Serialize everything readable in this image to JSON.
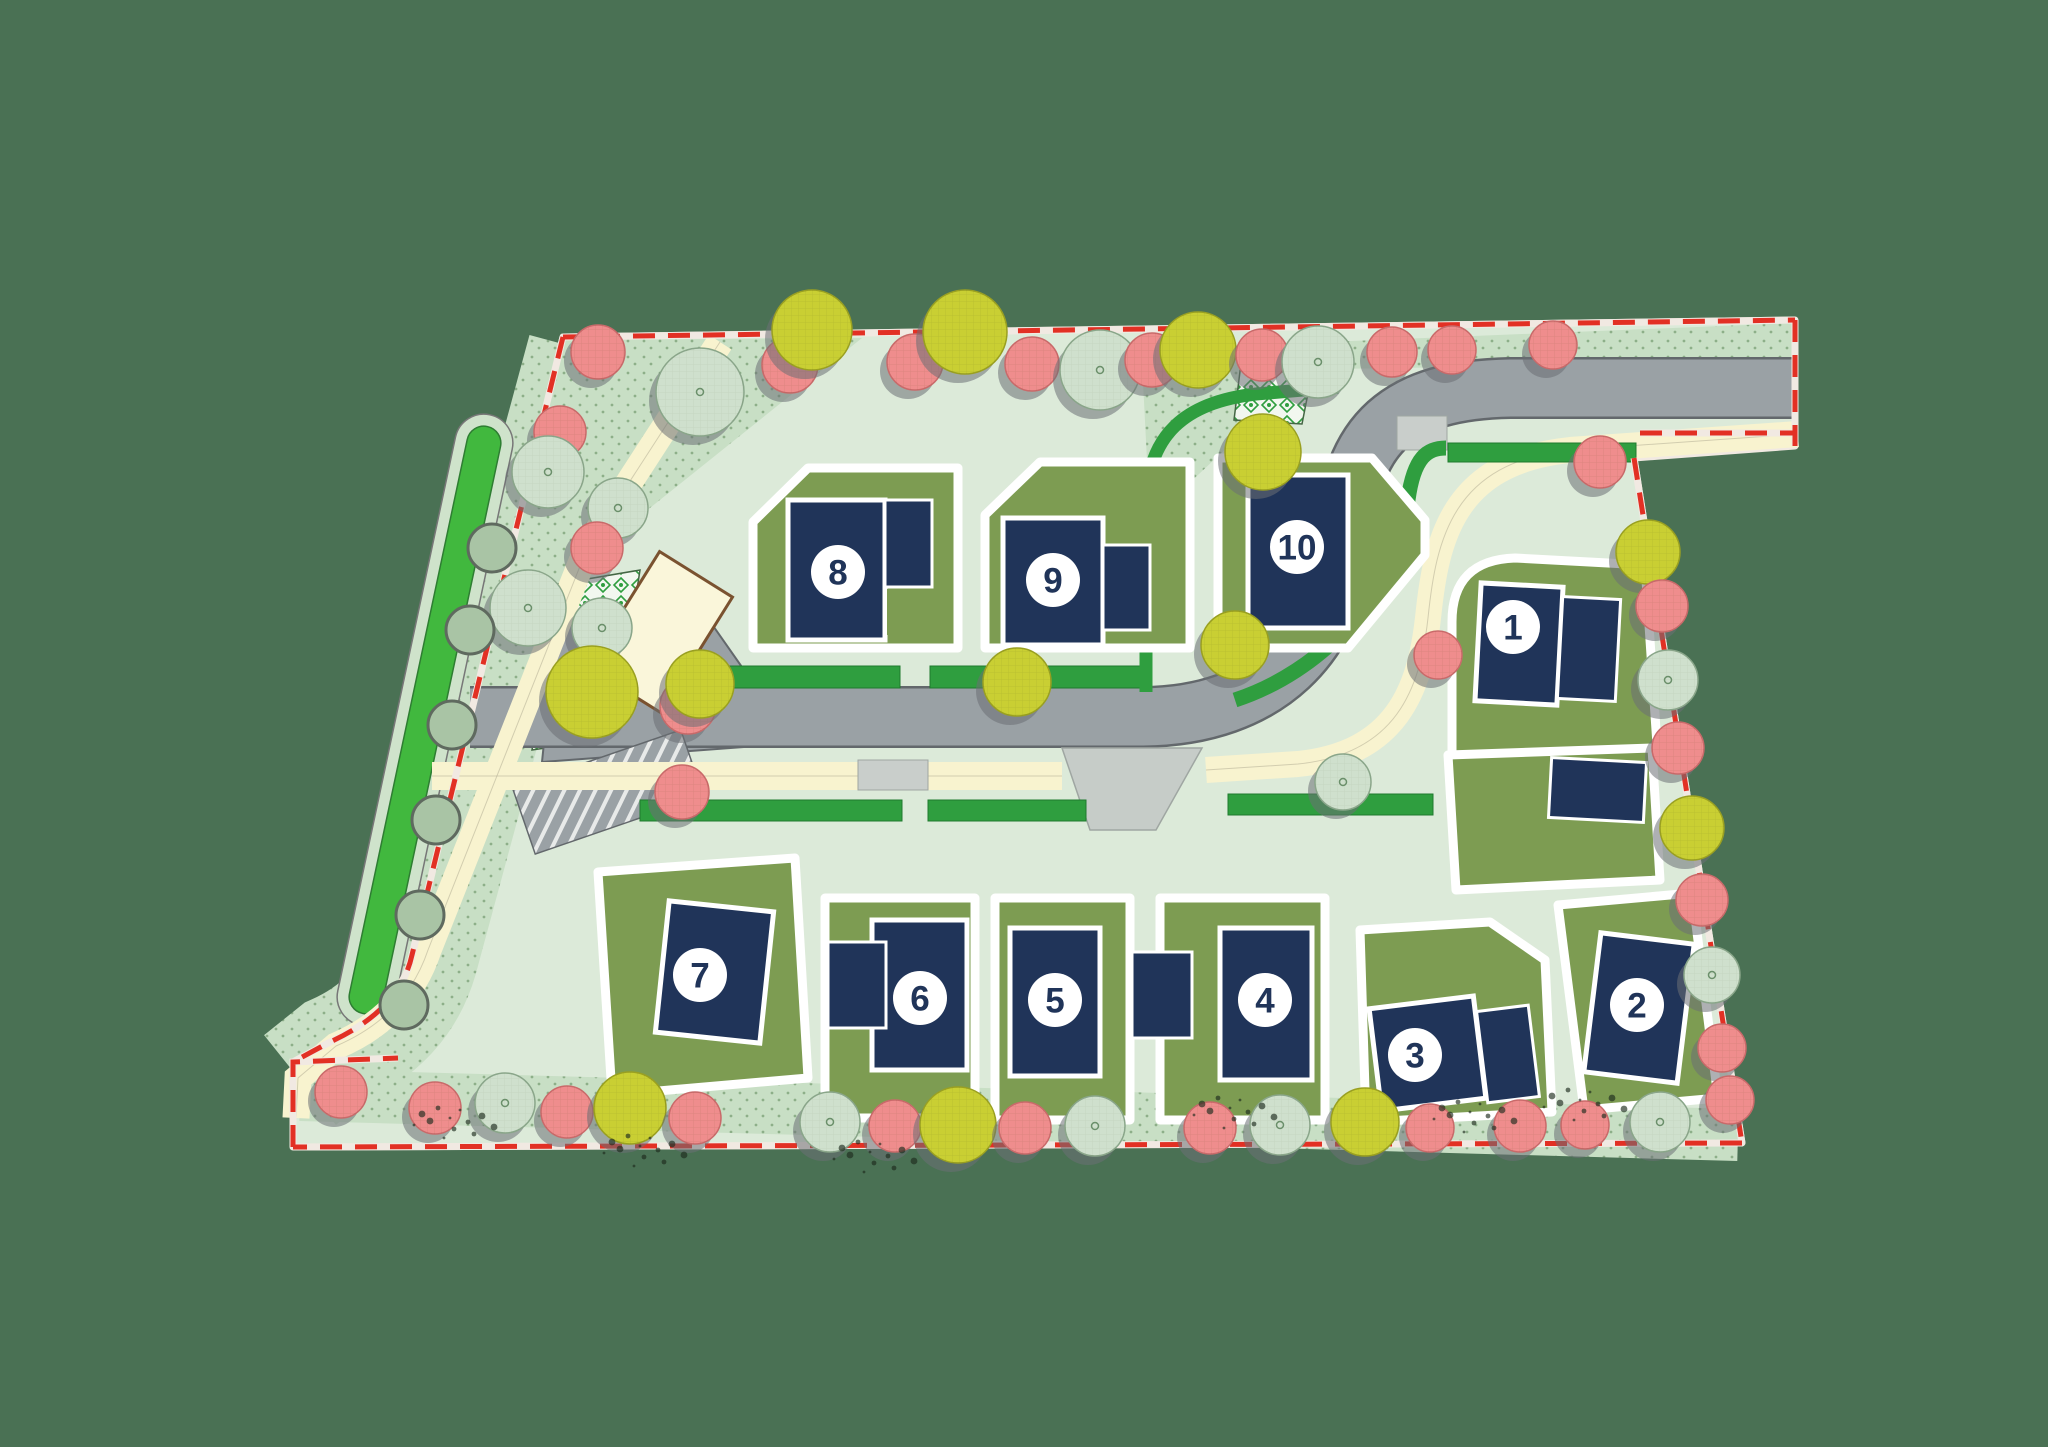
{
  "scene": {
    "width": 2048,
    "height": 1447,
    "label": "residential development site plan"
  },
  "colors": {
    "bg": "#4a7154",
    "site": "#dcead9",
    "planting": "#c8dfc5",
    "plantdot": "#5c8657",
    "garden": "#7d9c52",
    "house": "#203459",
    "houseStroke": "#ffffff",
    "road": "#9aa1a5",
    "roadEdge": "#63686c",
    "crossing": "#c9cecb",
    "bellmouth": "#c6ccc8",
    "cream": "#f8f3cf",
    "creamEdge": "#b9b49a",
    "hedge": "#2f9e3f",
    "swale": "#41b83e",
    "swaleOuter": "#cfe3cb",
    "swaleEdge": "#2e7d32",
    "boundaryRed": "#e23024",
    "rim": "#f1e9e2",
    "treePink": "#ef8d8d",
    "treePinkEdge": "#c96a6a",
    "treeGray": "#cfe0cd",
    "treeGrayEdge": "#8aa68a",
    "treeYellow": "#c9cf33",
    "treeYellowEdge": "#9aa021",
    "treeShadow": "#6b7074",
    "bush": "#a9c4a5",
    "bushEdge": "#5f6a5f",
    "circleFill": "#ffffff",
    "circleText": "#203459",
    "buildingFill": "#faf6da",
    "buildingStroke": "#7a5230",
    "checkerLine": "#446644",
    "scrub": "#1d2b1d"
  },
  "site": {
    "outline": [
      [
        563,
        337
      ],
      [
        1795,
        320
      ],
      [
        1795,
        446
      ],
      [
        1634,
        458
      ],
      [
        1742,
        1143
      ],
      [
        293,
        1147
      ],
      [
        293,
        1062
      ],
      [
        398,
        1058
      ],
      [
        412,
        955
      ]
    ],
    "planting_bands": [
      {
        "kind": "stroke",
        "d": "M 585,350 L 420,960 Q 402,1022 335,1052 L 300,1080",
        "w": 115
      },
      {
        "kind": "stroke",
        "d": "M 300,1095 L 1738,1135",
        "w": 52
      },
      {
        "kind": "poly",
        "pts": [
          [
            563,
            340
          ],
          [
            862,
            338
          ],
          [
            600,
            548
          ]
        ]
      },
      {
        "kind": "poly",
        "pts": [
          [
            1128,
            350
          ],
          [
            1795,
            323
          ],
          [
            1795,
            362
          ],
          [
            1136,
            372
          ]
        ]
      },
      {
        "kind": "poly",
        "pts": [
          [
            1142,
            362
          ],
          [
            1250,
            350
          ],
          [
            1248,
            428
          ],
          [
            1150,
            520
          ]
        ]
      }
    ]
  },
  "roads": {
    "main_path": "M 470,717 L 1140,717 C 1270,717 1338,640 1344,540 C 1350,432 1400,390 1510,388 L 1798,388",
    "entry_poly": [
      [
        556,
        626
      ],
      [
        702,
        610
      ],
      [
        758,
        690
      ],
      [
        758,
        746
      ],
      [
        542,
        762
      ]
    ],
    "hatch": {
      "cx": 608,
      "cy": 792,
      "w": 178,
      "h": 70,
      "rot": -19
    },
    "crossings": [
      [
        1397,
        416,
        50,
        34
      ],
      [
        858,
        760,
        70,
        30
      ]
    ],
    "bellmouth": [
      [
        1062,
        748
      ],
      [
        1202,
        748
      ],
      [
        1156,
        830
      ],
      [
        1090,
        830
      ]
    ]
  },
  "walks": [
    {
      "d": "M 432,776 L 1062,776",
      "w": 28
    },
    {
      "d": "M 1206,770 L 1298,764 C 1396,754 1420,690 1428,618 C 1436,540 1452,462 1570,450 L 1798,434",
      "w": 26
    },
    {
      "d": "M 720,342 L 588,546 L 428,950 Q 406,1016 336,1046 L 298,1078 L 296,1118",
      "w": 27
    }
  ],
  "hedges": {
    "rects": [
      [
        655,
        666,
        245,
        22
      ],
      [
        930,
        666,
        215,
        22
      ],
      [
        640,
        800,
        262,
        21
      ],
      [
        928,
        800,
        158,
        21
      ],
      [
        1228,
        794,
        205,
        21
      ],
      [
        1448,
        443,
        188,
        19
      ]
    ],
    "curves": [
      {
        "d": "M 1146,692 L 1146,508 C 1146,434 1186,402 1256,394 L 1338,387",
        "w": 13
      },
      {
        "d": "M 1235,700 C 1320,672 1396,596 1408,500 C 1414,456 1428,448 1446,448",
        "w": 15
      }
    ]
  },
  "swale": {
    "cx": 425,
    "cy": 720,
    "len": 600,
    "w": 34,
    "outerw": 58,
    "rot": 12
  },
  "checkers": [
    {
      "pts": [
        [
          1243,
          347
        ],
        [
          1318,
          342
        ],
        [
          1302,
          424
        ],
        [
          1234,
          420
        ]
      ],
      "lines": []
    },
    {
      "pts": [
        [
          558,
          584
        ],
        [
          640,
          570
        ],
        [
          614,
          738
        ],
        [
          532,
          750
        ]
      ],
      "lines": [
        [
          551,
          640,
          632,
          626
        ],
        [
          543,
          696,
          624,
          682
        ]
      ]
    }
  ],
  "building": {
    "cx": 660,
    "cy": 632,
    "w": 86,
    "h": 136,
    "rot": 32
  },
  "boundary": [
    "M 563,337 L 1795,320",
    "M 1795,320 L 1795,446",
    "M 1640,433 L 1795,433",
    "M 1634,458 L 1742,1143",
    "M 1742,1143 L 293,1147",
    "M 293,1147 L 293,1062 L 398,1058",
    "M 563,337 L 412,955 Q 400,1010 330,1042 L 293,1062"
  ],
  "gardens": [
    {
      "id": "plot-8",
      "pts": [
        [
          753,
          522
        ],
        [
          808,
          468
        ],
        [
          958,
          468
        ],
        [
          958,
          648
        ],
        [
          753,
          648
        ]
      ]
    },
    {
      "id": "plot-9",
      "pts": [
        [
          985,
          515
        ],
        [
          1040,
          462
        ],
        [
          1190,
          462
        ],
        [
          1190,
          648
        ],
        [
          985,
          648
        ]
      ]
    },
    {
      "id": "plot-10",
      "pts": [
        [
          1218,
          458
        ],
        [
          1372,
          458
        ],
        [
          1425,
          520
        ],
        [
          1425,
          555
        ],
        [
          1348,
          648
        ],
        [
          1218,
          648
        ]
      ]
    },
    {
      "id": "plot-1",
      "path": "M 1452,760 L 1452,622 Q 1452,560 1515,558 L 1645,565 L 1658,760 Z"
    },
    {
      "id": "plot-2-north",
      "pts": [
        [
          1448,
          755
        ],
        [
          1652,
          748
        ],
        [
          1660,
          880
        ],
        [
          1456,
          890
        ]
      ]
    },
    {
      "id": "plot-2",
      "pts": [
        [
          1558,
          905
        ],
        [
          1692,
          893
        ],
        [
          1718,
          1098
        ],
        [
          1584,
          1110
        ]
      ]
    },
    {
      "id": "plot-3",
      "pts": [
        [
          1360,
          930
        ],
        [
          1490,
          922
        ],
        [
          1545,
          960
        ],
        [
          1552,
          1112
        ],
        [
          1366,
          1122
        ]
      ]
    },
    {
      "id": "plot-4",
      "pts": [
        [
          1160,
          898
        ],
        [
          1325,
          898
        ],
        [
          1325,
          1120
        ],
        [
          1160,
          1120
        ]
      ]
    },
    {
      "id": "plot-5",
      "pts": [
        [
          995,
          898
        ],
        [
          1130,
          898
        ],
        [
          1130,
          1120
        ],
        [
          995,
          1120
        ]
      ]
    },
    {
      "id": "plot-6",
      "pts": [
        [
          825,
          898
        ],
        [
          975,
          898
        ],
        [
          975,
          1118
        ],
        [
          825,
          1118
        ]
      ]
    },
    {
      "id": "plot-7",
      "pts": [
        [
          598,
          872
        ],
        [
          795,
          858
        ],
        [
          808,
          1078
        ],
        [
          612,
          1095
        ]
      ]
    }
  ],
  "houses": [
    {
      "lot": "8",
      "x": 788,
      "y": 500,
      "w": 97,
      "h": 140,
      "rot": 0,
      "kind": "main"
    },
    {
      "lot": "8",
      "x": 885,
      "y": 500,
      "w": 47,
      "h": 87,
      "rot": 0,
      "kind": "garage"
    },
    {
      "lot": "9",
      "x": 1003,
      "y": 518,
      "w": 100,
      "h": 127,
      "rot": 0,
      "kind": "main"
    },
    {
      "lot": "9",
      "x": 1103,
      "y": 545,
      "w": 47,
      "h": 85,
      "rot": 0,
      "kind": "garage"
    },
    {
      "lot": "10",
      "x": 1248,
      "y": 475,
      "w": 100,
      "h": 153,
      "rot": 0,
      "kind": "main"
    },
    {
      "lot": "1",
      "x": 1478,
      "y": 585,
      "w": 82,
      "h": 118,
      "rot": 3,
      "kind": "main"
    },
    {
      "lot": "1",
      "x": 1560,
      "y": 598,
      "w": 58,
      "h": 102,
      "rot": 3,
      "kind": "garage"
    },
    {
      "lot": "2",
      "x": 1550,
      "y": 760,
      "w": 95,
      "h": 60,
      "rot": 3,
      "kind": "garage"
    },
    {
      "lot": "2",
      "x": 1592,
      "y": 938,
      "w": 94,
      "h": 140,
      "rot": 7,
      "kind": "main"
    },
    {
      "lot": "3",
      "x": 1375,
      "y": 1002,
      "w": 105,
      "h": 103,
      "rot": -7,
      "kind": "main"
    },
    {
      "lot": "3",
      "x": 1482,
      "y": 1008,
      "w": 52,
      "h": 92,
      "rot": -7,
      "kind": "garage"
    },
    {
      "lot": "4",
      "x": 1220,
      "y": 928,
      "w": 92,
      "h": 152,
      "rot": 0,
      "kind": "main"
    },
    {
      "lot": "4",
      "x": 1132,
      "y": 952,
      "w": 60,
      "h": 86,
      "rot": 0,
      "kind": "garage"
    },
    {
      "lot": "5",
      "x": 1010,
      "y": 928,
      "w": 90,
      "h": 148,
      "rot": 0,
      "kind": "main"
    },
    {
      "lot": "6",
      "x": 872,
      "y": 920,
      "w": 95,
      "h": 150,
      "rot": 0,
      "kind": "main"
    },
    {
      "lot": "6",
      "x": 828,
      "y": 942,
      "w": 58,
      "h": 86,
      "rot": 0,
      "kind": "garage"
    },
    {
      "lot": "7",
      "x": 662,
      "y": 906,
      "w": 105,
      "h": 132,
      "rot": 6,
      "kind": "main"
    }
  ],
  "notches": [
    [
      887,
      589,
      43,
      46
    ]
  ],
  "trees": [
    {
      "x": 598,
      "y": 352,
      "r": 27,
      "t": "pink"
    },
    {
      "x": 700,
      "y": 392,
      "r": 44,
      "t": "gray"
    },
    {
      "x": 790,
      "y": 365,
      "r": 28,
      "t": "pink"
    },
    {
      "x": 812,
      "y": 330,
      "r": 40,
      "t": "yellow"
    },
    {
      "x": 915,
      "y": 362,
      "r": 28,
      "t": "pink"
    },
    {
      "x": 965,
      "y": 332,
      "r": 42,
      "t": "yellow"
    },
    {
      "x": 1032,
      "y": 364,
      "r": 27,
      "t": "pink"
    },
    {
      "x": 1100,
      "y": 370,
      "r": 40,
      "t": "gray"
    },
    {
      "x": 1152,
      "y": 360,
      "r": 27,
      "t": "pink"
    },
    {
      "x": 1198,
      "y": 350,
      "r": 38,
      "t": "yellow"
    },
    {
      "x": 1262,
      "y": 355,
      "r": 26,
      "t": "pink"
    },
    {
      "x": 1318,
      "y": 362,
      "r": 36,
      "t": "gray"
    },
    {
      "x": 1392,
      "y": 352,
      "r": 25,
      "t": "pink"
    },
    {
      "x": 1452,
      "y": 350,
      "r": 24,
      "t": "pink"
    },
    {
      "x": 1553,
      "y": 345,
      "r": 24,
      "t": "pink"
    },
    {
      "x": 560,
      "y": 432,
      "r": 26,
      "t": "pink"
    },
    {
      "x": 548,
      "y": 472,
      "r": 36,
      "t": "gray"
    },
    {
      "x": 618,
      "y": 508,
      "r": 30,
      "t": "gray"
    },
    {
      "x": 597,
      "y": 548,
      "r": 26,
      "t": "pink"
    },
    {
      "x": 528,
      "y": 608,
      "r": 38,
      "t": "gray"
    },
    {
      "x": 602,
      "y": 628,
      "r": 30,
      "t": "gray"
    },
    {
      "x": 592,
      "y": 692,
      "r": 46,
      "t": "yellow"
    },
    {
      "x": 688,
      "y": 706,
      "r": 28,
      "t": "pink"
    },
    {
      "x": 682,
      "y": 792,
      "r": 27,
      "t": "pink"
    },
    {
      "x": 700,
      "y": 684,
      "r": 34,
      "t": "yellow"
    },
    {
      "x": 1017,
      "y": 682,
      "r": 34,
      "t": "yellow"
    },
    {
      "x": 1235,
      "y": 645,
      "r": 34,
      "t": "yellow"
    },
    {
      "x": 1263,
      "y": 452,
      "r": 38,
      "t": "yellow"
    },
    {
      "x": 1343,
      "y": 782,
      "r": 28,
      "t": "gray"
    },
    {
      "x": 1438,
      "y": 655,
      "r": 24,
      "t": "pink"
    },
    {
      "x": 1600,
      "y": 462,
      "r": 26,
      "t": "pink"
    },
    {
      "x": 1648,
      "y": 552,
      "r": 32,
      "t": "yellow"
    },
    {
      "x": 1662,
      "y": 606,
      "r": 26,
      "t": "pink"
    },
    {
      "x": 1668,
      "y": 680,
      "r": 30,
      "t": "gray"
    },
    {
      "x": 1678,
      "y": 748,
      "r": 26,
      "t": "pink"
    },
    {
      "x": 1692,
      "y": 828,
      "r": 32,
      "t": "yellow"
    },
    {
      "x": 1702,
      "y": 900,
      "r": 26,
      "t": "pink"
    },
    {
      "x": 1712,
      "y": 975,
      "r": 28,
      "t": "gray"
    },
    {
      "x": 1722,
      "y": 1048,
      "r": 24,
      "t": "pink"
    },
    {
      "x": 341,
      "y": 1092,
      "r": 26,
      "t": "pink"
    },
    {
      "x": 435,
      "y": 1108,
      "r": 26,
      "t": "pink"
    },
    {
      "x": 505,
      "y": 1103,
      "r": 30,
      "t": "gray"
    },
    {
      "x": 567,
      "y": 1112,
      "r": 26,
      "t": "pink"
    },
    {
      "x": 630,
      "y": 1108,
      "r": 36,
      "t": "yellow"
    },
    {
      "x": 695,
      "y": 1118,
      "r": 26,
      "t": "pink"
    },
    {
      "x": 830,
      "y": 1122,
      "r": 30,
      "t": "gray"
    },
    {
      "x": 895,
      "y": 1126,
      "r": 26,
      "t": "pink"
    },
    {
      "x": 958,
      "y": 1125,
      "r": 38,
      "t": "yellow"
    },
    {
      "x": 1025,
      "y": 1128,
      "r": 26,
      "t": "pink"
    },
    {
      "x": 1095,
      "y": 1126,
      "r": 30,
      "t": "gray"
    },
    {
      "x": 1210,
      "y": 1128,
      "r": 26,
      "t": "pink"
    },
    {
      "x": 1280,
      "y": 1125,
      "r": 30,
      "t": "gray"
    },
    {
      "x": 1365,
      "y": 1122,
      "r": 34,
      "t": "yellow"
    },
    {
      "x": 1430,
      "y": 1128,
      "r": 24,
      "t": "pink"
    },
    {
      "x": 1520,
      "y": 1126,
      "r": 26,
      "t": "pink"
    },
    {
      "x": 1585,
      "y": 1125,
      "r": 24,
      "t": "pink"
    },
    {
      "x": 1660,
      "y": 1122,
      "r": 30,
      "t": "gray"
    },
    {
      "x": 1730,
      "y": 1100,
      "r": 24,
      "t": "pink"
    }
  ],
  "bushes": [
    [
      492,
      548
    ],
    [
      470,
      630
    ],
    [
      452,
      725
    ],
    [
      436,
      820
    ],
    [
      420,
      915
    ],
    [
      404,
      1005
    ]
  ],
  "scrubs": [
    [
      450,
      1118
    ],
    [
      640,
      1146
    ],
    [
      870,
      1152
    ],
    [
      1230,
      1108
    ],
    [
      1470,
      1112
    ],
    [
      1580,
      1100
    ]
  ],
  "lots": [
    {
      "number": "1",
      "x": 1513,
      "y": 627
    },
    {
      "number": "2",
      "x": 1637,
      "y": 1005
    },
    {
      "number": "3",
      "x": 1415,
      "y": 1055
    },
    {
      "number": "4",
      "x": 1265,
      "y": 1000
    },
    {
      "number": "5",
      "x": 1055,
      "y": 1000
    },
    {
      "number": "6",
      "x": 920,
      "y": 998
    },
    {
      "number": "7",
      "x": 700,
      "y": 975
    },
    {
      "number": "8",
      "x": 838,
      "y": 572
    },
    {
      "number": "9",
      "x": 1053,
      "y": 580
    },
    {
      "number": "10",
      "x": 1297,
      "y": 547
    }
  ],
  "marker": {
    "radius": 27,
    "fontSize": 35
  }
}
